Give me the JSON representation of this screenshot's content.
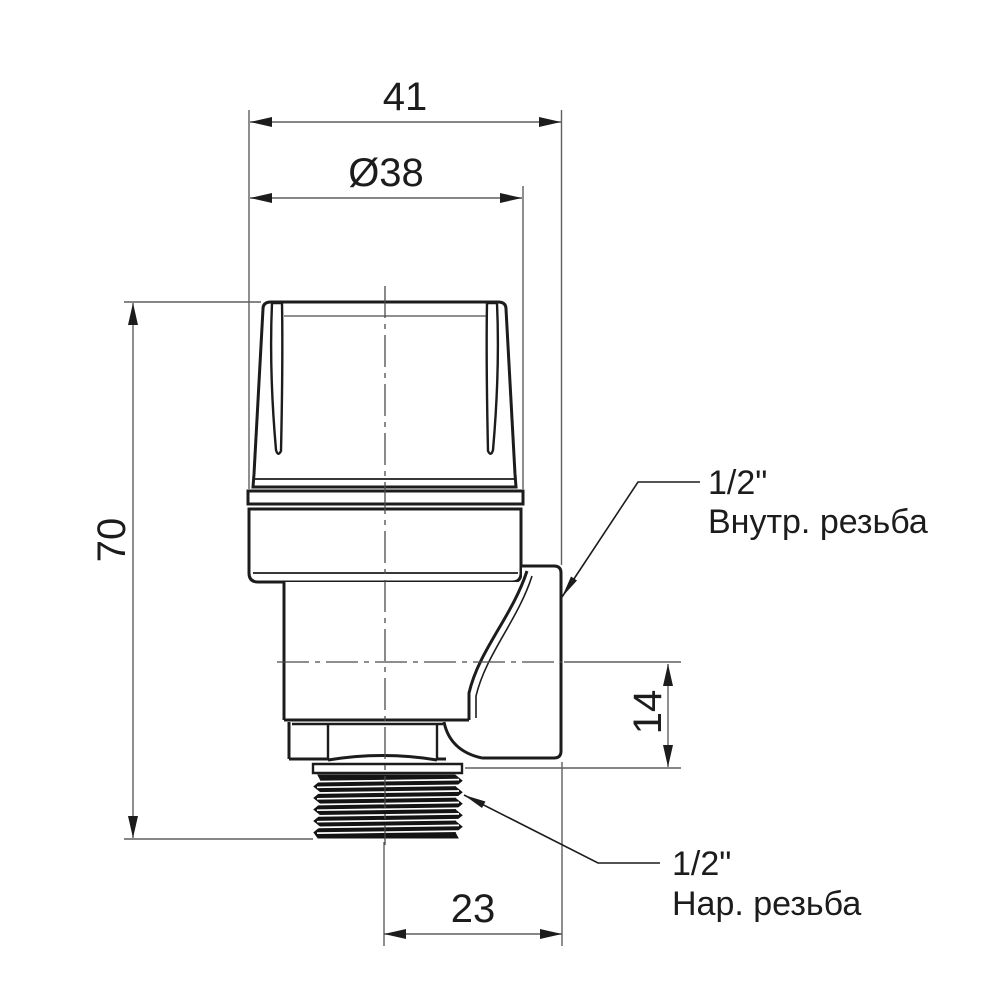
{
  "dimensions": {
    "width_total": "41",
    "cap_diameter": "Ø38",
    "height_total": "70",
    "outlet_center_offset": "14",
    "outlet_face_offset": "23"
  },
  "callouts": {
    "inlet": {
      "size": "1/2\"",
      "thread": "Внутр. резьба"
    },
    "outlet": {
      "size": "1/2\"",
      "thread": "Нар. резьба"
    }
  },
  "colors": {
    "outline": "#1c1c1c",
    "dimension_line": "#5f5f5f",
    "background": "#ffffff"
  }
}
